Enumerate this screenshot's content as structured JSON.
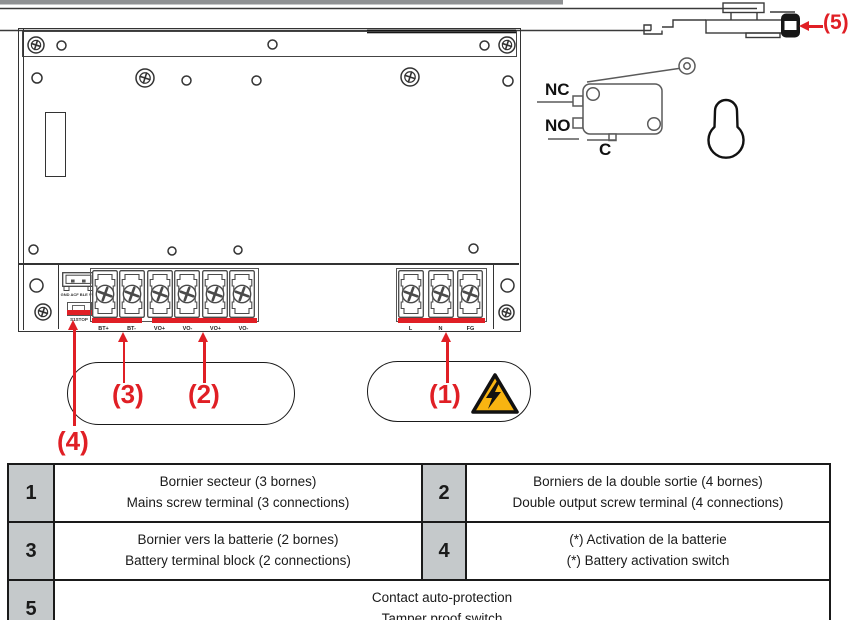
{
  "colors": {
    "red_accent": "#e01f25",
    "warning_yellow": "#f8b411",
    "table_number_bg": "#c5c9cb",
    "drawing_line": "#333333"
  },
  "icons": {
    "warning_triangle": "high-voltage-warning",
    "screw": "phillips-screw",
    "hole": "mounting-hole",
    "keyhole": "keyhole-mount-slot",
    "microswitch": "roller-lever-microswitch",
    "tamper_plunger": "tamper-switch-plunger"
  },
  "callouts": {
    "c1": "(1)",
    "c2": "(2)",
    "c3": "(3)",
    "c4": "(4)",
    "c5": "(5)"
  },
  "microswitch": {
    "nc_label": "NC",
    "no_label": "NO",
    "c_label": "C"
  },
  "panel": {
    "connector_label": "GND ACF BLE VCC",
    "activation_switch_label": "S1STOP",
    "battery_terminal_labels": [
      "BT+",
      "BT-"
    ],
    "output_terminal_labels": [
      "VO+",
      "VO-",
      "VO+",
      "VO-"
    ],
    "mains_terminal_labels": [
      "L",
      "N",
      "FG"
    ]
  },
  "legend_table": {
    "row1": {
      "num_left": "1",
      "left_fr": "Bornier secteur (3 bornes)",
      "left_en": "Mains screw terminal (3 connections)",
      "num_right": "2",
      "right_fr": "Borniers de la double sortie (4 bornes)",
      "right_en": "Double output screw terminal (4 connections)"
    },
    "row2": {
      "num_left": "3",
      "left_fr": "Bornier vers la batterie (2 bornes)",
      "left_en": "Battery terminal block (2 connections)",
      "num_right": "4",
      "right_fr": "(*) Activation de la batterie",
      "right_en": "(*) Battery activation switch"
    },
    "row3": {
      "num": "5",
      "fr": "Contact auto-protection",
      "en": "Tamper proof switch"
    }
  }
}
